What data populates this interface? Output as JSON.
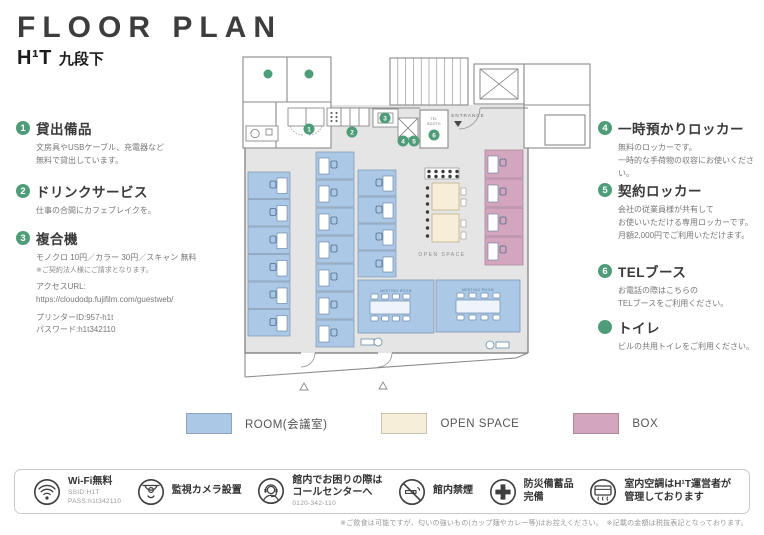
{
  "colors": {
    "accent": "#4e9d78",
    "wall": "#8a8a8a",
    "floor": "#e5e5e5"
  },
  "header": {
    "title": "FLOOR PLAN",
    "brand": "H¹T",
    "location": "九段下"
  },
  "left_items": [
    {
      "num": "1",
      "title": "貸出備品",
      "lines": [
        "文房具やUSBケーブル、充電器など",
        "無料で貸出しています。"
      ]
    },
    {
      "num": "2",
      "title": "ドリンクサービス",
      "lines": [
        "仕事の合間にカフェブレイクを。"
      ]
    },
    {
      "num": "3",
      "title": "複合機",
      "lines": [
        "モノクロ 10円／カラー 30円／スキャン 無料",
        "※ご契約法人様にご請求となります。",
        "アクセスURL:",
        "https://cloudodp.fujifilm.com/guestweb/",
        "プリンターID:957-h1t",
        "パスワード:h1t342110"
      ]
    }
  ],
  "right_items": [
    {
      "num": "4",
      "title": "一時預かりロッカー",
      "lines": [
        "無料のロッカーです。",
        "一時的な手荷物の収容にお使いください。"
      ]
    },
    {
      "num": "5",
      "title": "契約ロッカー",
      "lines": [
        "会社の従業員様が共有して",
        "お使いいただける専用ロッカーです。",
        "月額2,000円でご利用いただけます。"
      ]
    },
    {
      "num": "6",
      "title": "TELブース",
      "lines": [
        "お電話の際はこちらの",
        "TELブースをご利用ください。"
      ]
    },
    {
      "num": "",
      "title": "トイレ",
      "lines": [
        "ビルの共用トイレをご利用ください。"
      ]
    }
  ],
  "plan": {
    "labels": {
      "entrance": "ENTRANCE",
      "tel_line1": "TEL",
      "tel_line2": "BOOTH",
      "open_space": "OPEN SPACE",
      "meeting_room": "MEETING ROOM"
    },
    "markers": [
      "1",
      "2",
      "3",
      "4",
      "5",
      "6"
    ]
  },
  "legend": {
    "items": [
      {
        "label": "ROOM(会議室)",
        "color": "#abc8e6"
      },
      {
        "label": "OPEN SPACE",
        "color": "#f6eed8"
      },
      {
        "label": "BOX",
        "color": "#d4a6be"
      }
    ]
  },
  "footer": {
    "items": [
      {
        "icon": "wifi-icon",
        "title": "Wi-Fi無料",
        "sub": [
          "SSID:H1T",
          "PASS:h1t342110"
        ]
      },
      {
        "icon": "camera-icon",
        "title": "監視カメラ設置",
        "sub": []
      },
      {
        "icon": "headset-icon",
        "title": "館内でお困りの際は\nコールセンターへ",
        "sub": [
          "0120-342-110"
        ]
      },
      {
        "icon": "no-smoking-icon",
        "title": "館内禁煙",
        "sub": []
      },
      {
        "icon": "first-aid-icon",
        "title": "防災備蓄品\n完備",
        "sub": []
      },
      {
        "icon": "ac-icon",
        "title": "室内空調はH¹T運営者が\n管理しております",
        "sub": []
      }
    ]
  },
  "disclaimer": "※ご飲食は可能ですが、匂いの強いもの(カップ麺やカレー等)はお控えください。　※記載の金額は税抜表記となっております。"
}
